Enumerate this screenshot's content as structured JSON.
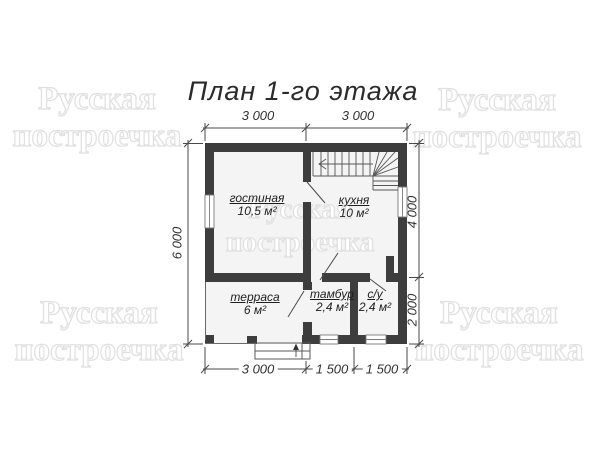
{
  "title": "План 1-го этажа",
  "watermark": {
    "line1": "Русская",
    "line2": "построечка"
  },
  "rooms": {
    "living": {
      "name": "гостиная",
      "area": "10,5 м²"
    },
    "kitchen": {
      "name": "кухня",
      "area": "10 м²"
    },
    "terrace": {
      "name": "терраса",
      "area": "6 м²"
    },
    "vestibule": {
      "name": "тамбур",
      "area": "2,4 м²"
    },
    "bathroom": {
      "name": "с/у",
      "area": "2,4 м²"
    }
  },
  "dimensions": {
    "top": [
      "3 000",
      "3 000"
    ],
    "left": [
      "6 000"
    ],
    "right": [
      "4 000",
      "2 000"
    ],
    "bottom": [
      "3 000",
      "1 500",
      "1 500"
    ]
  },
  "colors": {
    "wall": "#3d3d3d",
    "floor": "#f4f4f4",
    "line": "#4a4a4a",
    "watermark_outline": "#e0e0e0"
  }
}
